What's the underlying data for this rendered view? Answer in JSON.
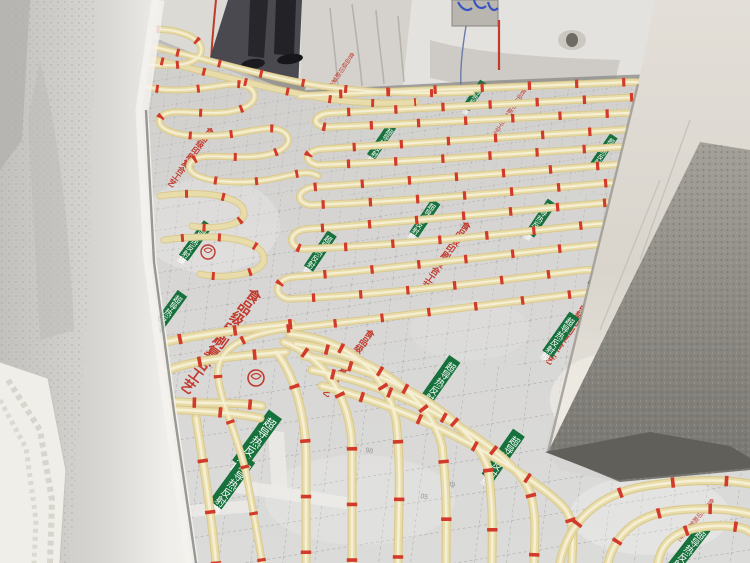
{
  "scene": {
    "kind": "construction-site photo: underfloor heating PEX pipe loops on silver insulation film",
    "floor_print": {
      "red_process_text": "食品级印刷复合工艺",
      "green_label_text": "超导热反射膜",
      "grid_numbers": [
        "05",
        "49",
        "86",
        "98"
      ]
    },
    "colors": {
      "pipe": "#e9dcab",
      "pipe_highlight": "#f7f2d8",
      "clip_red": "#d23a2b",
      "print_red": "#c23a2c",
      "label_green": "#17713c",
      "foil": "#d6d5d3",
      "wall_white": "#e8e6e2",
      "concrete_rough": "#8f8c86"
    }
  }
}
